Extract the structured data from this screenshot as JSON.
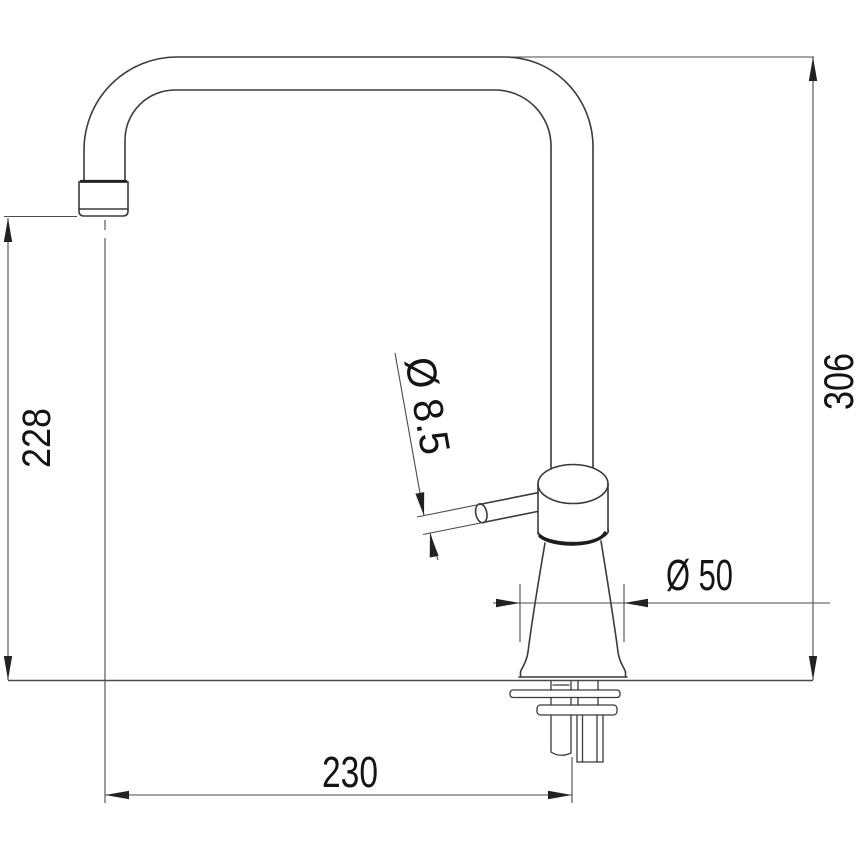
{
  "drawing": {
    "type": "faucet-installation-dimension-drawing",
    "labels": {
      "spout_height": "228",
      "total_height": "306",
      "spout_reach": "230",
      "lever_diameter": "Ø 8.5",
      "body_diameter": "Ø 50"
    },
    "colors": {
      "outline": "#3a3a3a",
      "dimension": "#4a4a4a",
      "text": "#141414",
      "background": "#ffffff"
    }
  }
}
